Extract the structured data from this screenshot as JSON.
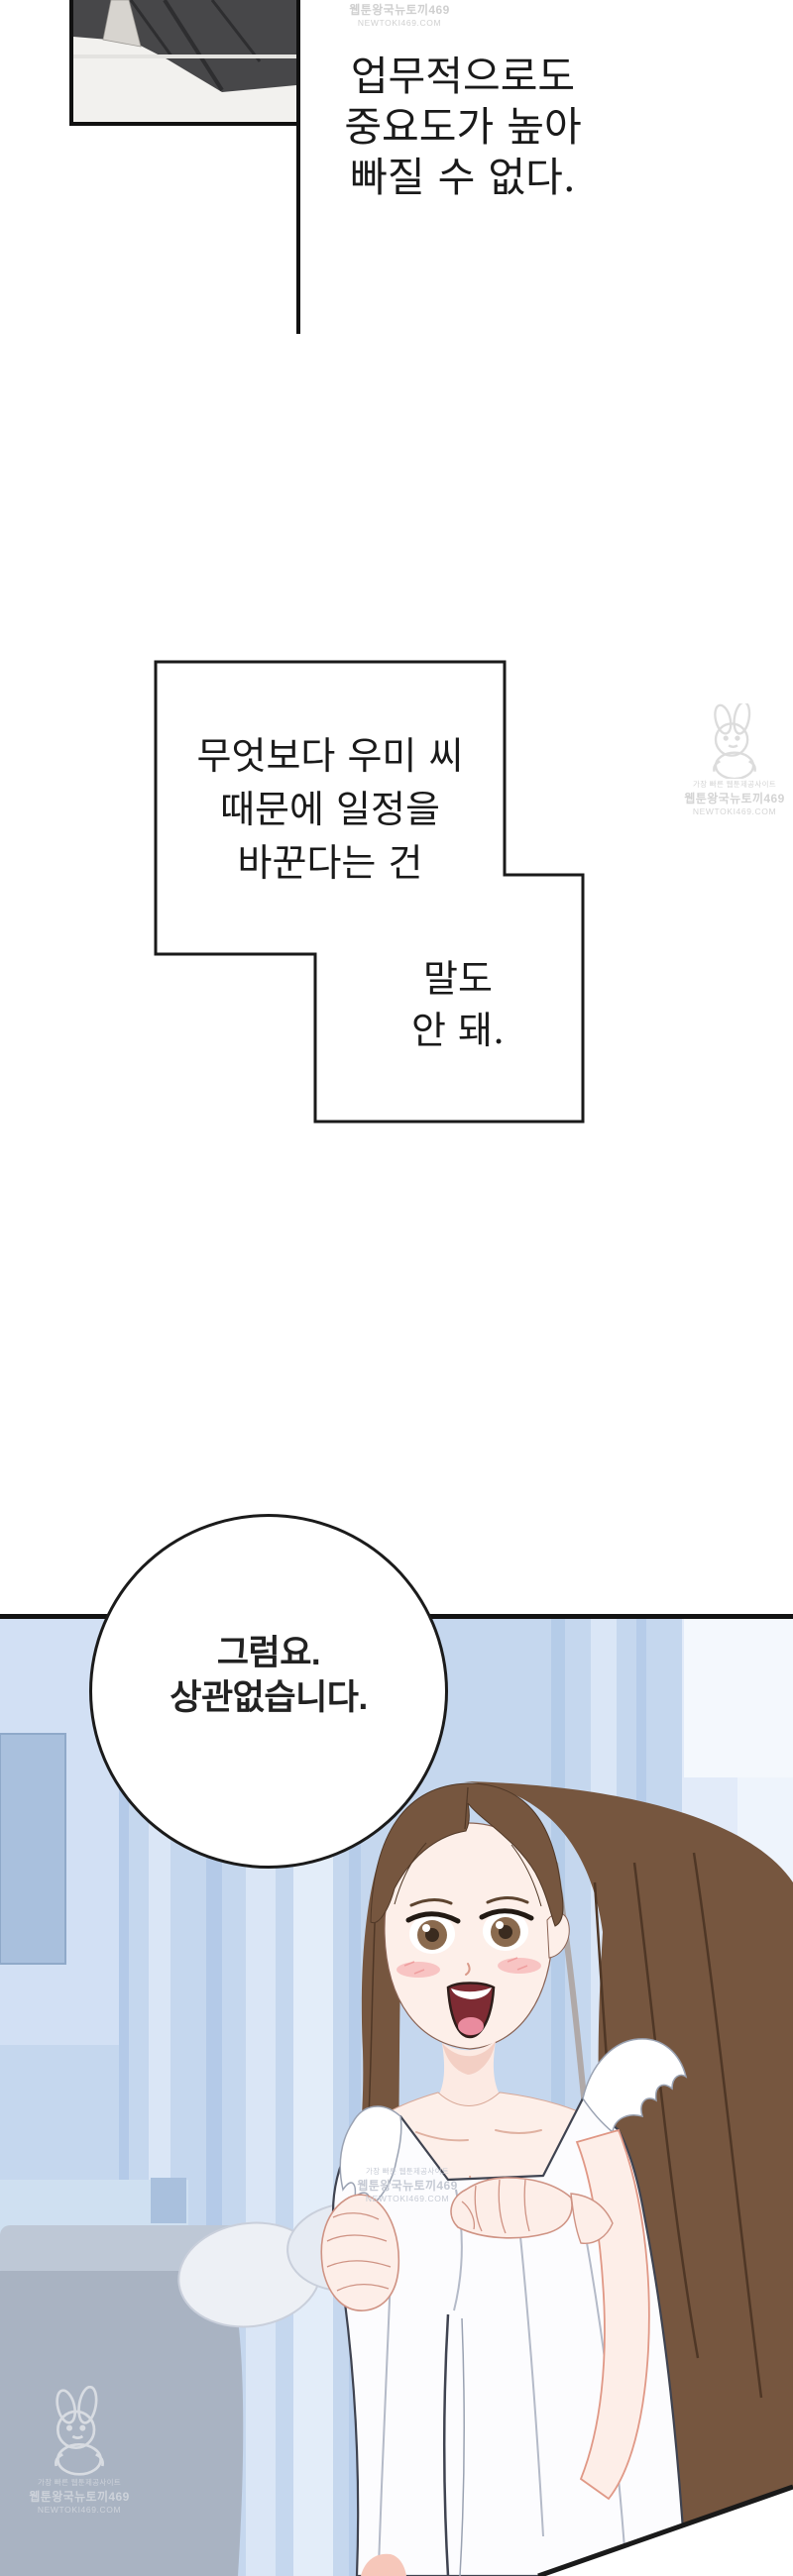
{
  "page": {
    "kind": "webtoon-episode-page",
    "background": "#ffffff"
  },
  "narration_top": {
    "lines": [
      "업무적으로도",
      "중요도가 높아",
      "빠질 수 없다."
    ]
  },
  "narration_mid_main": {
    "lines": [
      "무엇보다 우미 씨",
      "때문에 일정을",
      "바꾼다는 건"
    ]
  },
  "narration_mid_sub": {
    "lines": [
      "말도",
      "안 돼."
    ]
  },
  "speech_bubble": {
    "lines": [
      "그럼요.",
      "상관없습니다."
    ]
  },
  "watermarks": {
    "tagline": "가장 빠른 웹툰제공사이트",
    "site": "웹툰왕국뉴토끼469",
    "domain": "NEWTOKI469.COM",
    "icon": "rabbit-mascot-icon",
    "color": "#d0d0d0"
  },
  "colors": {
    "panel_border": "#111111",
    "narration_text": "#1a1a1a",
    "bubble_outline": "#1b1b1b",
    "curtain_blue": "#c5d7ee",
    "curtain_highlight": "#e8f1fb",
    "couch_gray": "#a9b3c2",
    "wall_window_blue": "#a9c0dd",
    "hair_brown": "#76563f",
    "skin": "#fdefe9",
    "blush": "#f6b9b9",
    "mouth_red": "#7e2b33",
    "dress_white": "#fcfcfe"
  }
}
